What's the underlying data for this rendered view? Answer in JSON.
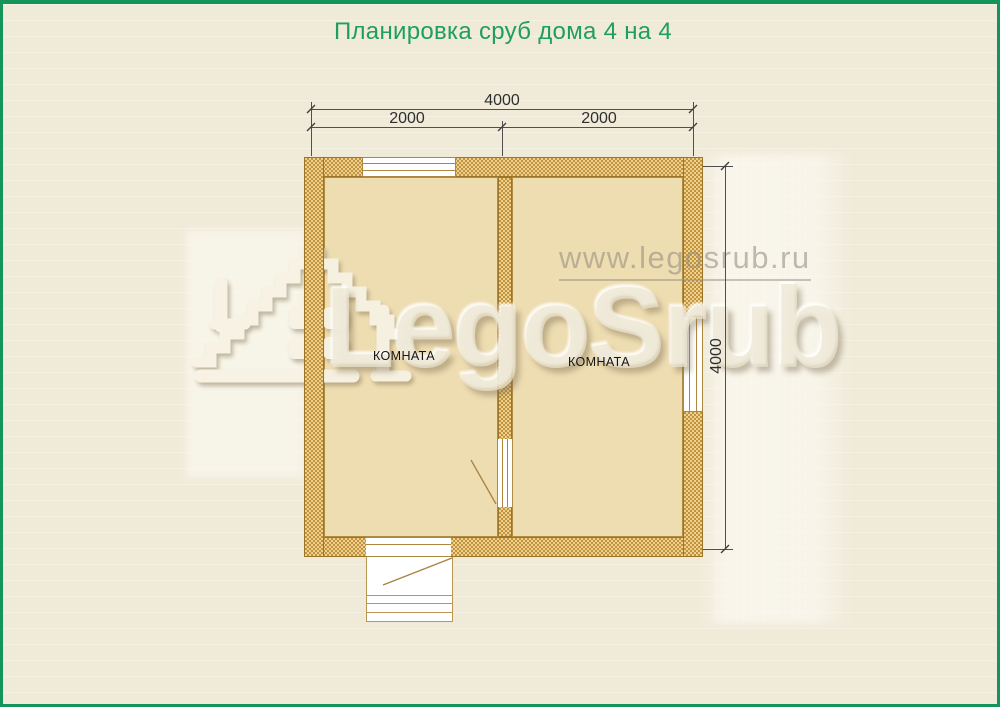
{
  "page": {
    "title": "Планировка сруб дома 4 на 4"
  },
  "watermark": {
    "brand": "LegoSrub",
    "url": "www.legosrub.ru"
  },
  "plan": {
    "room_left": {
      "label": "КОМНАТА"
    },
    "room_right": {
      "label": "КОМНАТА"
    },
    "dims": {
      "total_width": "4000",
      "split_left": "2000",
      "split_right": "2000",
      "total_height": "4000"
    }
  },
  "colors": {
    "accent_green": "#14935a",
    "title_green": "#1f9e60",
    "wall_gold": "#d7ac52",
    "floor_tan": "#efddb2",
    "background_cream": "#f0ebd9"
  }
}
